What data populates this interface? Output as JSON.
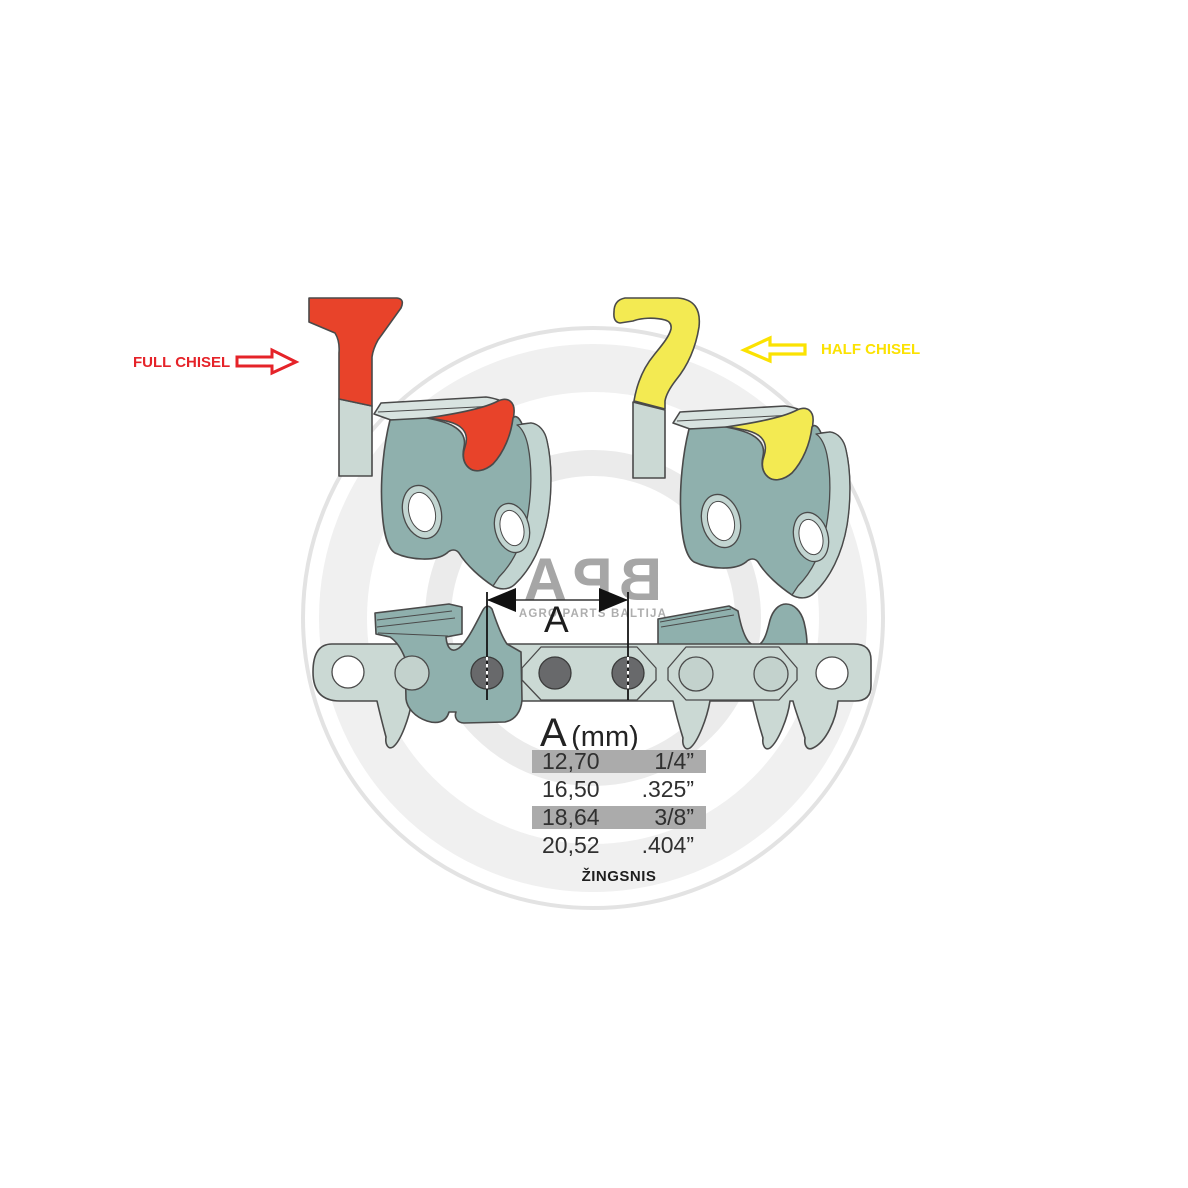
{
  "labels": {
    "full_chisel": "FULL CHISEL",
    "half_chisel": "HALF CHISEL",
    "dimension": "A",
    "pitch_caption": "ŽINGSNIS"
  },
  "watermark": {
    "letters": [
      "A",
      "P",
      "B"
    ],
    "subtitle": "AGRO PARTS BALTIJA"
  },
  "table": {
    "header": {
      "symbol": "A",
      "unit": "(mm)"
    },
    "rows": [
      {
        "mm": "12,70",
        "inch": "1/4”"
      },
      {
        "mm": "16,50",
        "inch": ".325”"
      },
      {
        "mm": "18,64",
        "inch": "3/8”"
      },
      {
        "mm": "20,52",
        "inch": ".404”"
      }
    ]
  },
  "colors": {
    "red_label": "#e52329",
    "red_accent": "#e8432a",
    "yellow_label": "#fbe202",
    "yellow_accent": "#f3ea52",
    "teal_body": "#8fb0ad",
    "teal_light": "#c2d5d1",
    "plate_light": "#d8e3e0",
    "strap": "#cbd9d4",
    "strap_hole_light": "#c3d2cd",
    "rivet": "#68696b",
    "outline": "#4a4a4a",
    "table_band": "#ababab",
    "watermark_text": "#a6a6a6",
    "watermark_sub": "#aeaeae",
    "ring_light": "#f0f0f0",
    "ring_line": "#e3e3e3"
  }
}
